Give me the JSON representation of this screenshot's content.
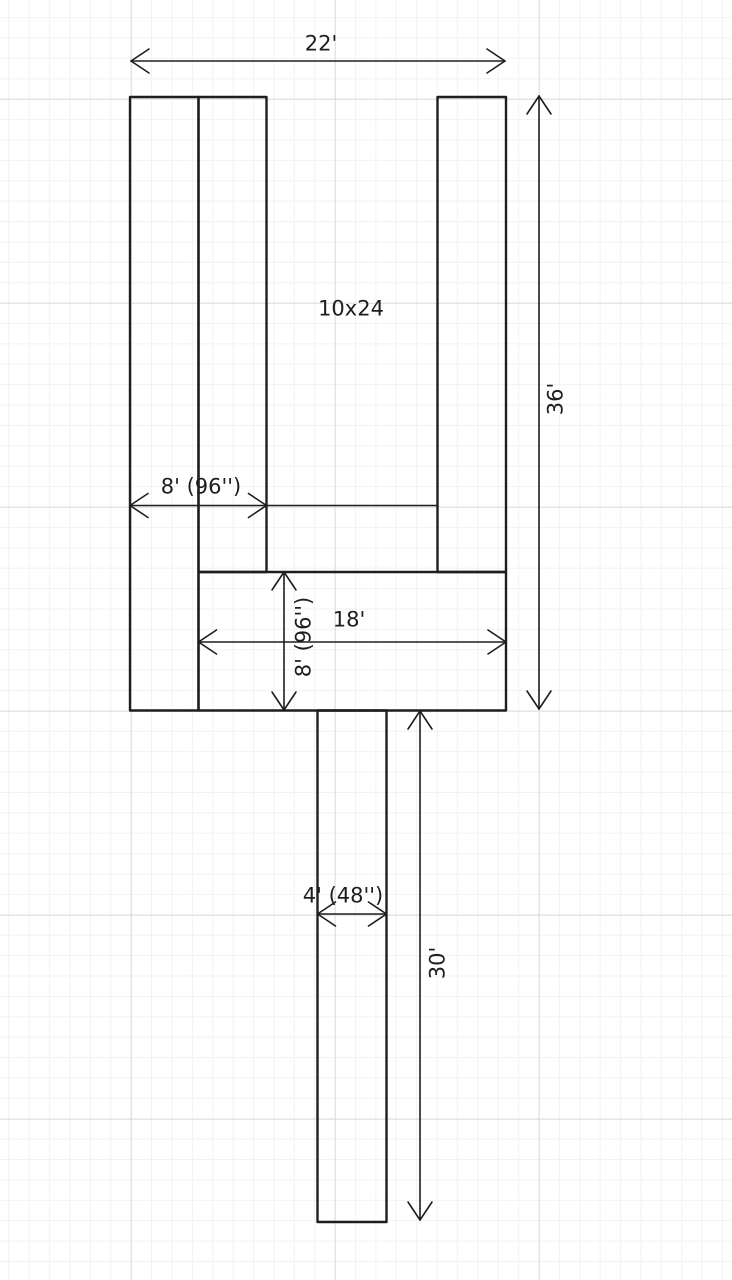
{
  "canvas": {
    "width": 732,
    "height": 1280,
    "background_color": "#ffffff",
    "grid_minor_color": "#f2f2f2",
    "grid_major_color": "#dadada",
    "grid_minor_spacing": 20.4,
    "grid_major_spacing": 204
  },
  "drawing": {
    "stroke_color": "#1e1e1e",
    "shape_stroke_width": 2.4,
    "dim_stroke_width": 1.6,
    "rects": [
      {
        "name": "left-outer-slip-rect",
        "x": 130,
        "y": 97,
        "w": 68.5,
        "h": 613.5
      },
      {
        "name": "left-inner-slip-rect",
        "x": 198.5,
        "y": 97,
        "w": 68,
        "h": 475
      },
      {
        "name": "right-slip-rect",
        "x": 437.5,
        "y": 97,
        "w": 68.5,
        "h": 475
      },
      {
        "name": "head-section-rect",
        "x": 198.5,
        "y": 572,
        "w": 307.5,
        "h": 138.5
      },
      {
        "name": "walkway-rect",
        "x": 317.5,
        "y": 710.5,
        "w": 69,
        "h": 511.5
      }
    ],
    "dimensions": [
      {
        "name": "dim-overall-width",
        "orientation": "horizontal",
        "label": "22'",
        "pos": 61,
        "shaft_start": 131,
        "shaft_end": 505,
        "tip1": 131,
        "tip2": 505,
        "label_cx": 321,
        "label_cy": 44,
        "rotated": false
      },
      {
        "name": "dim-overall-length",
        "orientation": "vertical",
        "label": "36'",
        "pos": 539,
        "shaft_start": 96,
        "shaft_end": 709,
        "tip1": 96,
        "tip2": 709,
        "label_cx": 556,
        "label_cy": 399,
        "rotated": true
      },
      {
        "name": "dim-slips-width",
        "orientation": "horizontal",
        "label": "8' (96'')",
        "pos": 505.5,
        "shaft_start": 130,
        "shaft_end": 437.5,
        "tip1": 130,
        "tip2": 266.5,
        "label_cx": 201,
        "label_cy": 487,
        "rotated": false
      },
      {
        "name": "dim-head-width",
        "orientation": "horizontal",
        "label": "18'",
        "pos": 642,
        "shaft_start": 198.5,
        "shaft_end": 506,
        "tip1": 198.5,
        "tip2": 506,
        "label_cx": 349,
        "label_cy": 620,
        "rotated": false
      },
      {
        "name": "dim-head-depth",
        "orientation": "vertical",
        "label": "8' (96'')",
        "pos": 284,
        "shaft_start": 572,
        "shaft_end": 710,
        "tip1": 572,
        "tip2": 710,
        "label_cx": 304,
        "label_cy": 637,
        "rotated": true
      },
      {
        "name": "dim-walkway-width",
        "orientation": "horizontal",
        "label": "4' (48'')",
        "pos": 914,
        "shaft_start": 317.5,
        "shaft_end": 386.5,
        "tip1": 317.5,
        "tip2": 386.5,
        "label_cx": 343,
        "label_cy": 896,
        "rotated": false
      },
      {
        "name": "dim-walkway-length",
        "orientation": "vertical",
        "label": "30'",
        "pos": 420,
        "shaft_start": 711,
        "shaft_end": 1220,
        "tip1": 711,
        "tip2": 1220,
        "label_cx": 438,
        "label_cy": 963,
        "rotated": true
      }
    ],
    "labels": [
      {
        "name": "slip-size-label",
        "text": "10x24",
        "cx": 351,
        "cy": 309
      }
    ]
  }
}
